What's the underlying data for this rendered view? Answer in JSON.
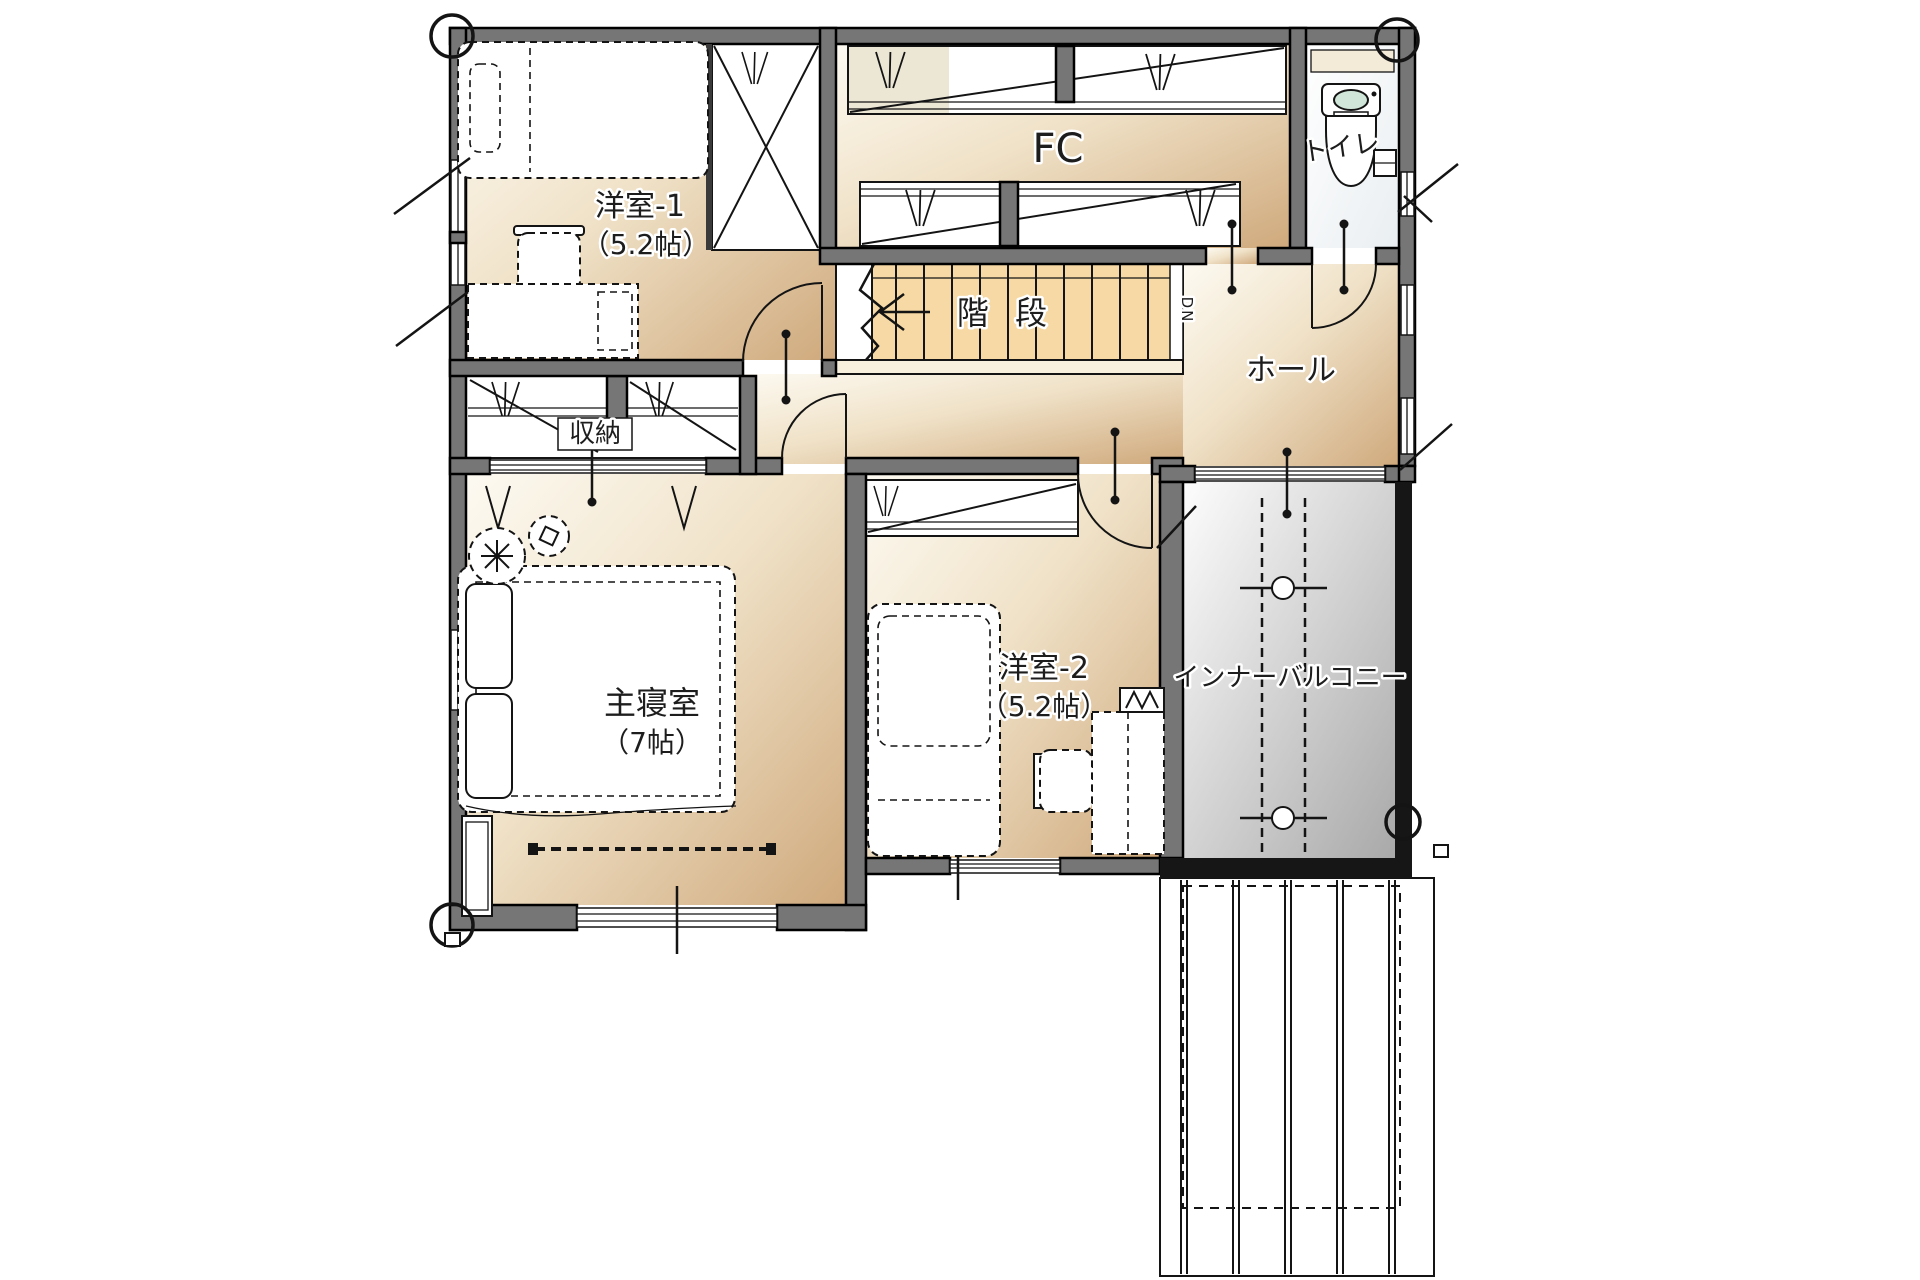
{
  "plan": {
    "labels": {
      "room1_name": "洋室-1",
      "room1_size": "（5.2帖）",
      "fc": "FC",
      "toilet": "トイレ",
      "stairs": "階 段",
      "down": "DN",
      "hall": "ホール",
      "storage": "収納",
      "master_name": "主寝室",
      "master_size": "（7帖）",
      "room2_name": "洋室-2",
      "room2_size": "（5.2帖）",
      "balcony": "インナーバルコニー"
    },
    "colors": {
      "wall": "#767676",
      "wall_dark": "#161616",
      "floor_light": "#fdfaf2",
      "floor_mid": "#f0e2c8",
      "floor_dark": "#cfa97c",
      "stairs": "#f6d9a4",
      "rail": "#f8efdc",
      "closet_tint": "#ece7d5",
      "balcony_light": "#fdfdfd",
      "balcony_dark": "#a9a9a9",
      "toilet_light": "#ffffff",
      "toilet_dark": "#e9eef1",
      "tank_lid": "#cfe6d8",
      "sill": "#f3ead8",
      "line": "#141414"
    }
  }
}
